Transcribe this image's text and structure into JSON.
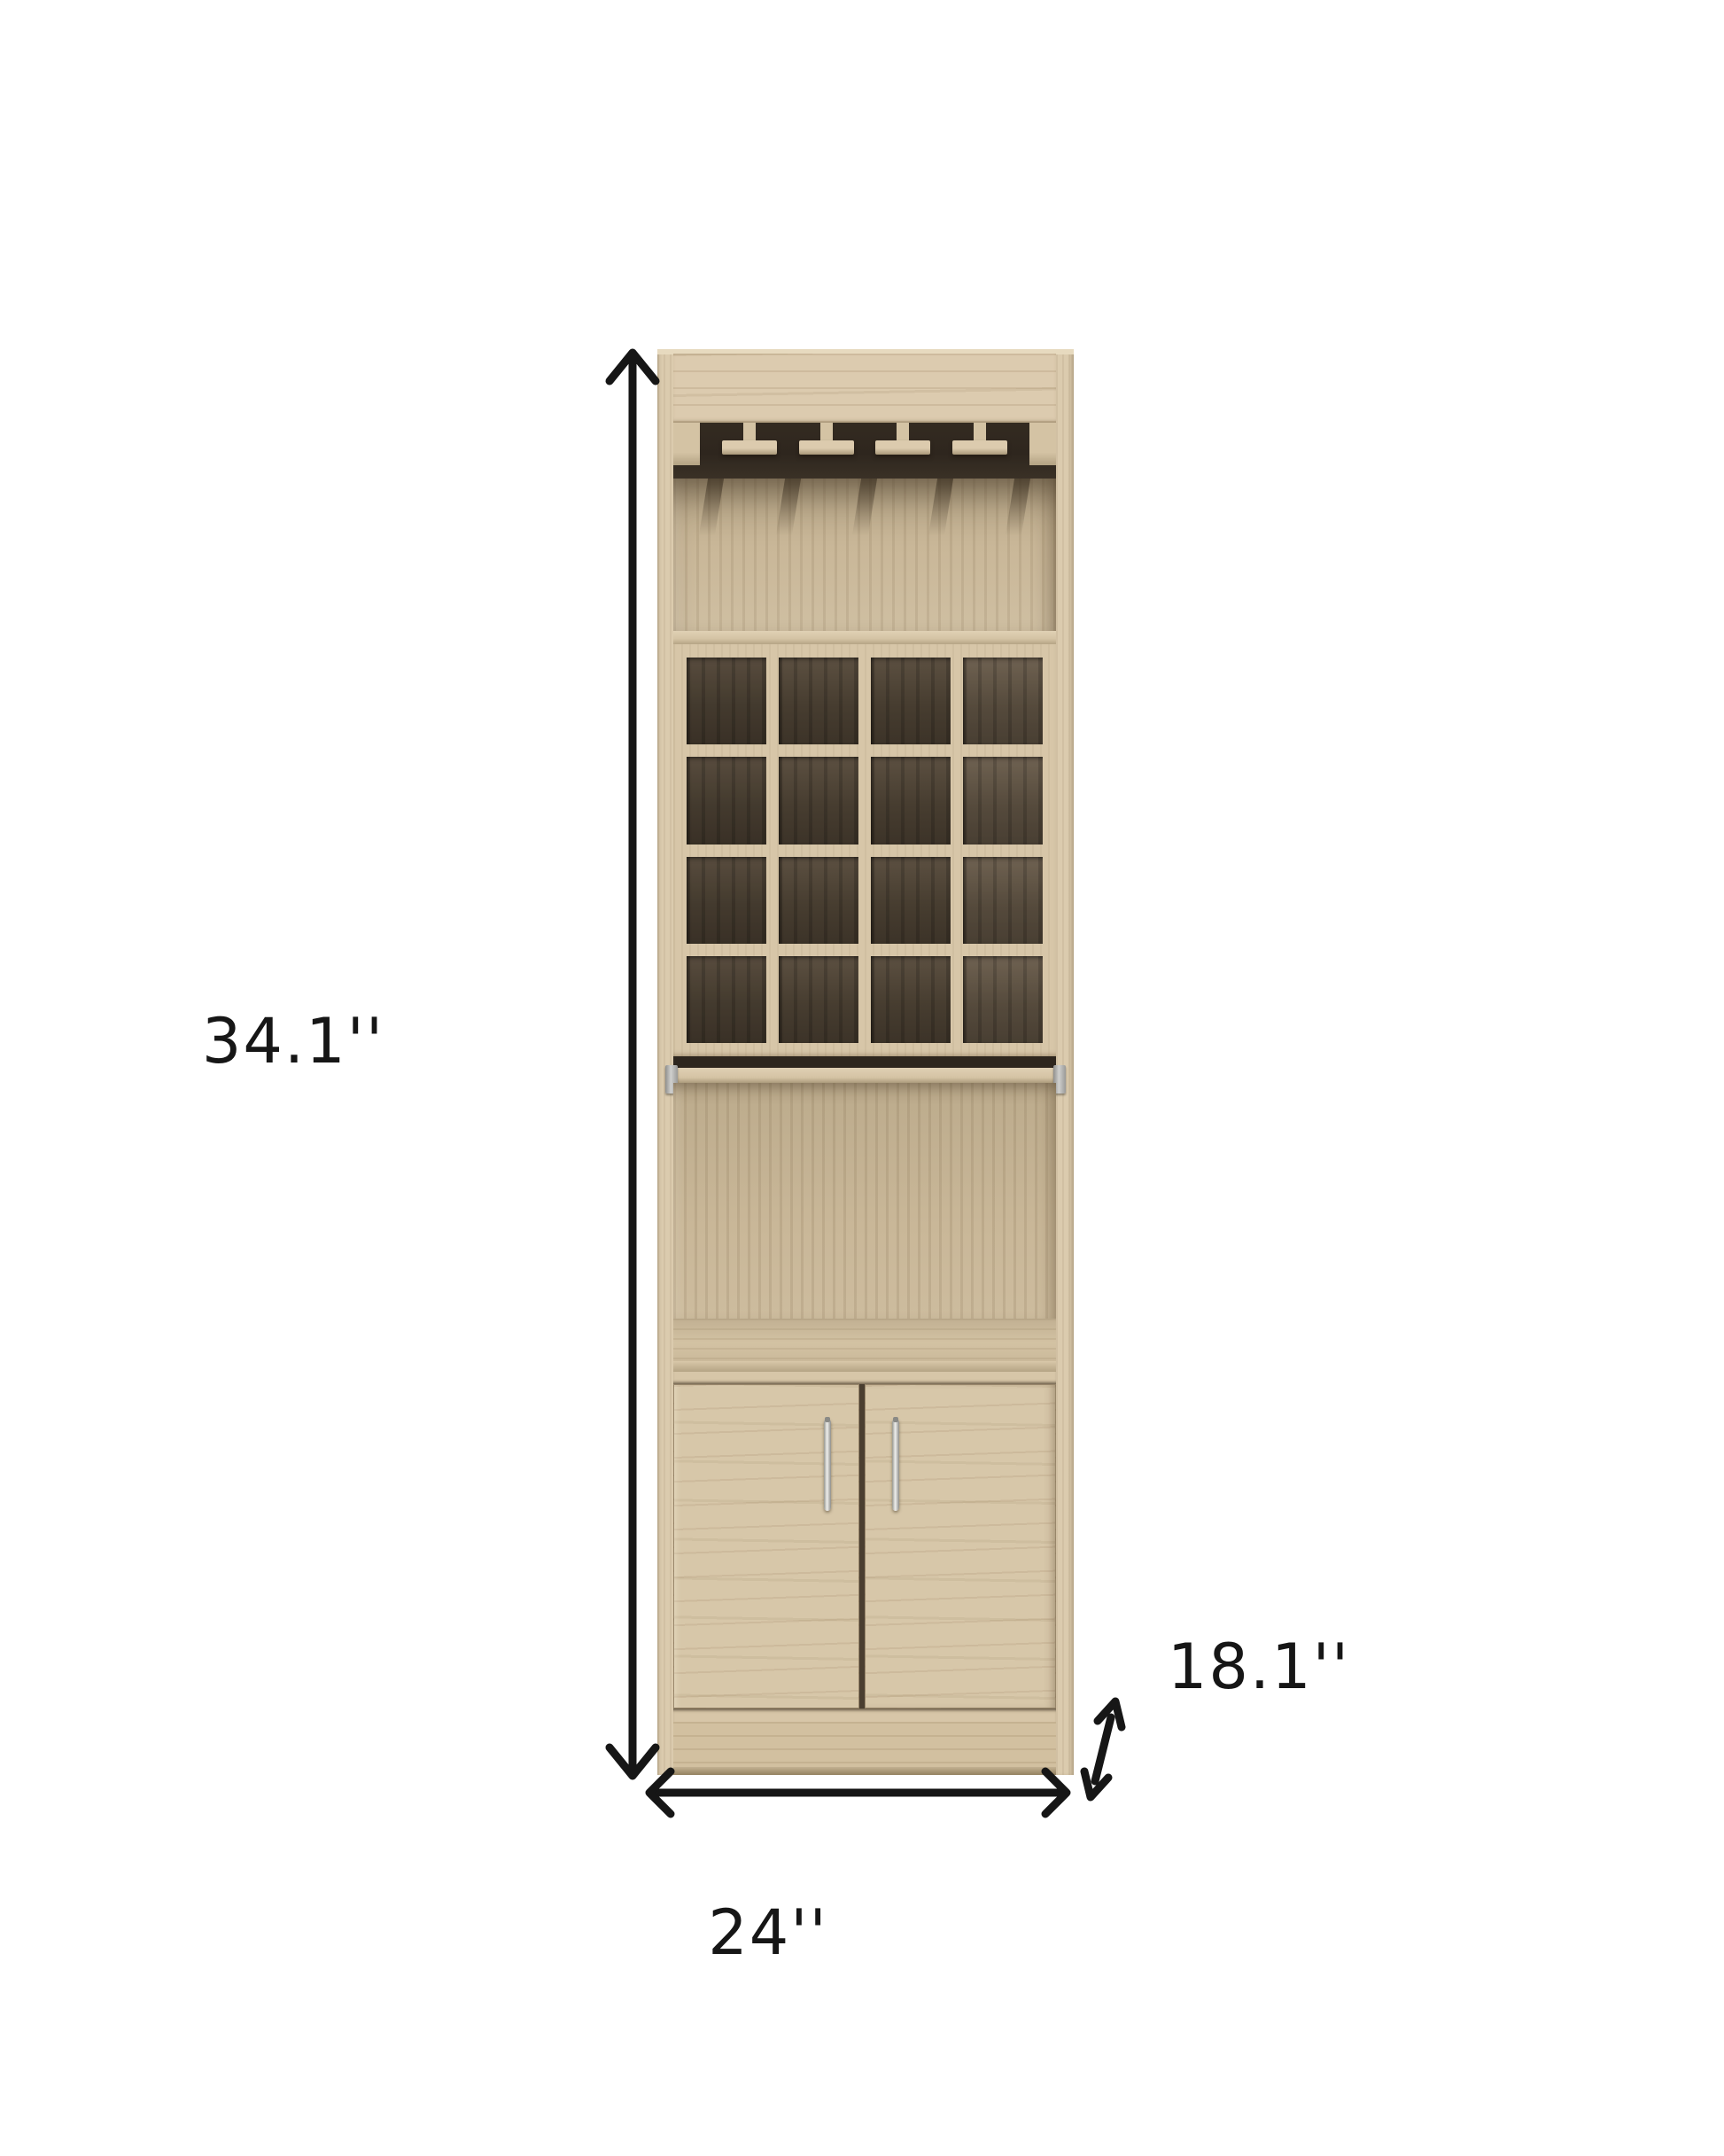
{
  "diagram": {
    "type": "product-dimension-diagram",
    "subject": "bar cabinet with stemware rack, wine cubbies, pull-out tray and two-door storage",
    "dimensions": {
      "height": "34.1''",
      "width": "24''",
      "depth": "18.1''"
    },
    "structure": {
      "stemware_rails": 4,
      "stemware_slots": 5,
      "wine_cubbies": 16,
      "cubby_columns": 4,
      "cubby_rows": 4,
      "doors": 2,
      "handles": 2
    },
    "colors": {
      "bg": "#ffffff",
      "ink": "#161616",
      "frame": "#d7c6a8",
      "crown": "#dccbaf",
      "stile": "#dbcbae",
      "topedge": "#e7dabf",
      "rail": "#d4c3a4",
      "slot": "#2e261e",
      "cubby": "#473d30",
      "back": "#c9b798",
      "door": "#d7c7a9",
      "kick": "#d2c0a0",
      "metal": "#d0d0ce",
      "metal-dark": "#8f8f8d"
    }
  }
}
